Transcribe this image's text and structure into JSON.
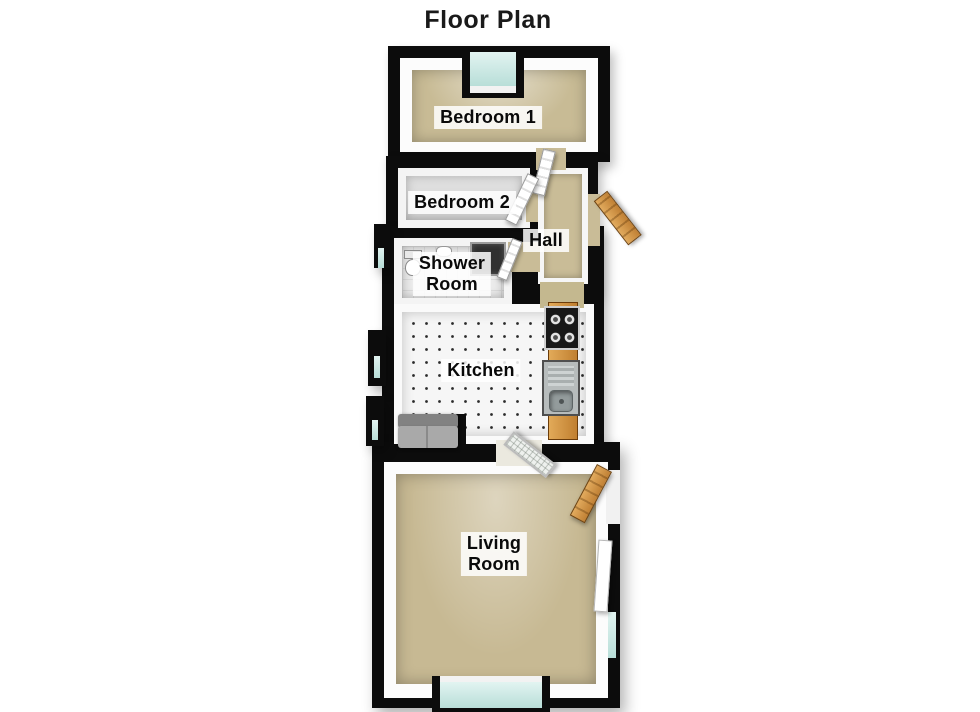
{
  "title": "Floor Plan",
  "rooms": [
    {
      "id": "bedroom-1",
      "label": "Bedroom 1"
    },
    {
      "id": "bedroom-2",
      "label": "Bedroom 2"
    },
    {
      "id": "hall",
      "label": "Hall"
    },
    {
      "id": "shower-room",
      "label": "Shower\nRoom"
    },
    {
      "id": "kitchen",
      "label": "Kitchen"
    },
    {
      "id": "living-room",
      "label": "Living\nRoom"
    }
  ],
  "fixtures": {
    "kitchen": [
      "gas-hob",
      "sink-with-drainer",
      "worktop-counter",
      "sofa"
    ],
    "shower_room": [
      "toilet",
      "wash-basin",
      "shower-cubicle"
    ],
    "doors": [
      "front-door-wood",
      "bedroom-1-door",
      "bedroom-2-door",
      "shower-room-door",
      "kitchen-living-glazed-door",
      "living-room-side-door-wood"
    ],
    "windows": [
      "bay-window-top",
      "bay-window-bottom",
      "left-wall-window-1",
      "left-wall-window-2",
      "left-wall-window-3",
      "right-wall-window"
    ]
  },
  "colors": {
    "wall": "#0c0c0c",
    "wall_face": "#ffffff",
    "carpet_beige": "#c8bb95",
    "carpet_grey": "#d9d9d9",
    "floor_tile": "#f6f6f6",
    "window_glass": "#cde9e5",
    "wood": "#d79a4c",
    "label_background": "#ffffff",
    "text": "#111111"
  }
}
